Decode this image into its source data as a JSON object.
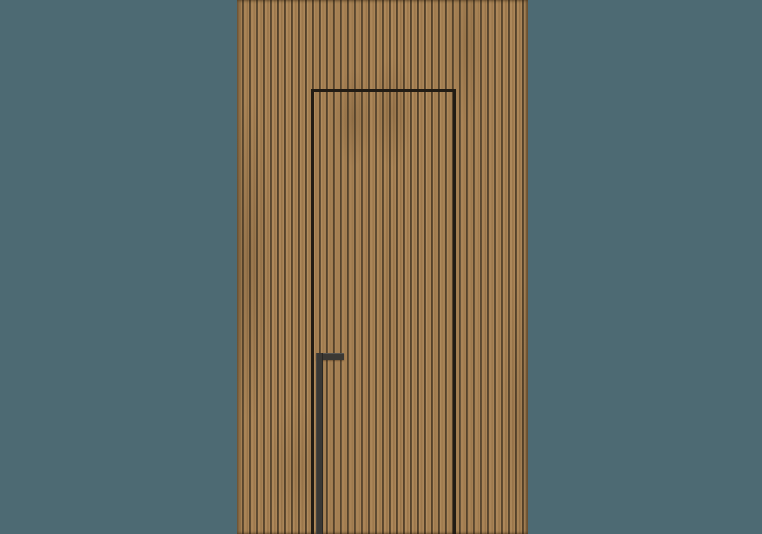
{
  "scene": {
    "description": "Rendered product image of a concealed flush door with a recessed matte-black pull handle, set into a floor-to-ceiling wall panel of narrow vertical wood slats on a muted teal backdrop.",
    "elements": {
      "background": "muted teal studio backdrop",
      "panel": "vertical wood slat wall panel",
      "door": "concealed door outlined by a thin dark seam, cropped at bottom edge",
      "handle": "recessed inverted-L pull handle, matte black"
    }
  },
  "colors": {
    "bg": "#4d6a73",
    "slat": "#aa8456",
    "slat_shade": "#9c784c",
    "slat_light": "#b08a5b",
    "groove": "#3f301d",
    "groove_edge": "#7a6141",
    "door_seam": "#221c14",
    "handle": "#3a3834"
  }
}
